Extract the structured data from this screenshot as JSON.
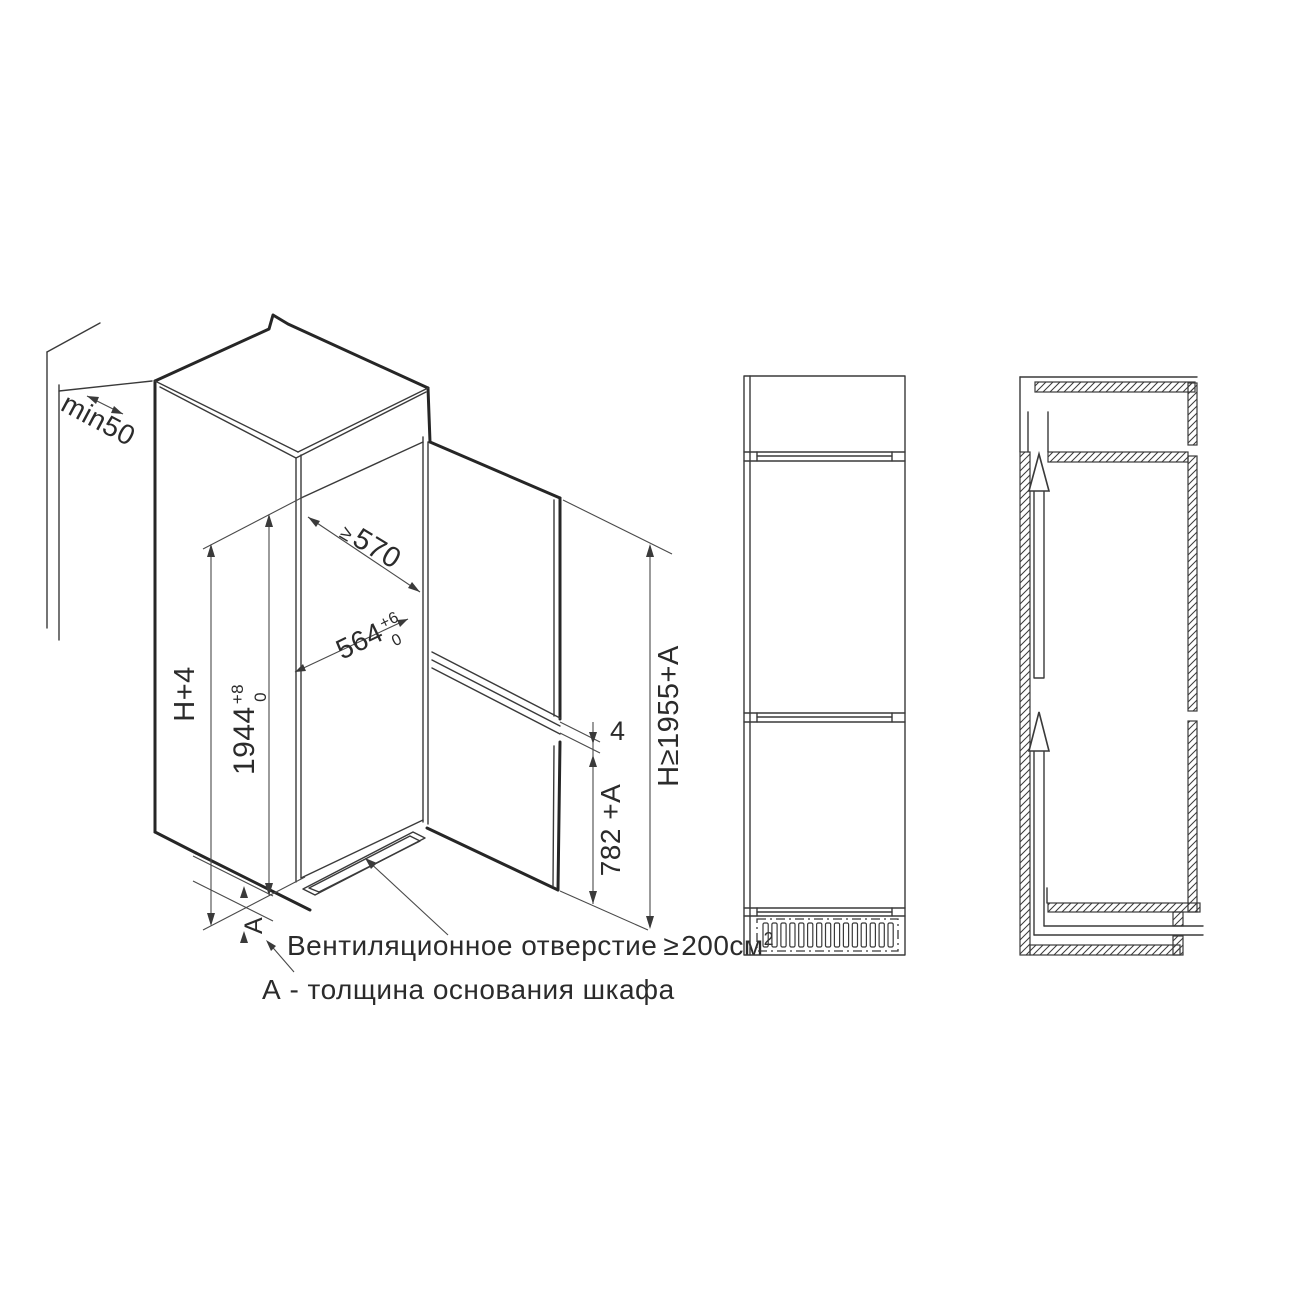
{
  "palette": {
    "background": "#ffffff",
    "line": "#2b2b2b"
  },
  "iso": {
    "dims": {
      "wall_gap": "min50",
      "housing_height": "H+4",
      "niche_height": {
        "base": "1944",
        "sup": "+8",
        "sub": "0"
      },
      "depth": {
        "prefix": "≥",
        "value": "570"
      },
      "width": {
        "base": "564",
        "sup": "+6",
        "sub": "0"
      },
      "door_gap": "4",
      "lower_door": "782 +A",
      "total_height": "H≥1955+A",
      "base_thickness": "А"
    },
    "notes": {
      "vent_text": "Вентиляционное отверстие",
      "vent_symbol": "≥",
      "vent_value": "200см",
      "vent_sup": "2",
      "base_note": "А - толщина основания шкафа"
    }
  },
  "front_view": {
    "grille_slats": 15
  },
  "section_view": {
    "airflow_arrows": 2
  }
}
